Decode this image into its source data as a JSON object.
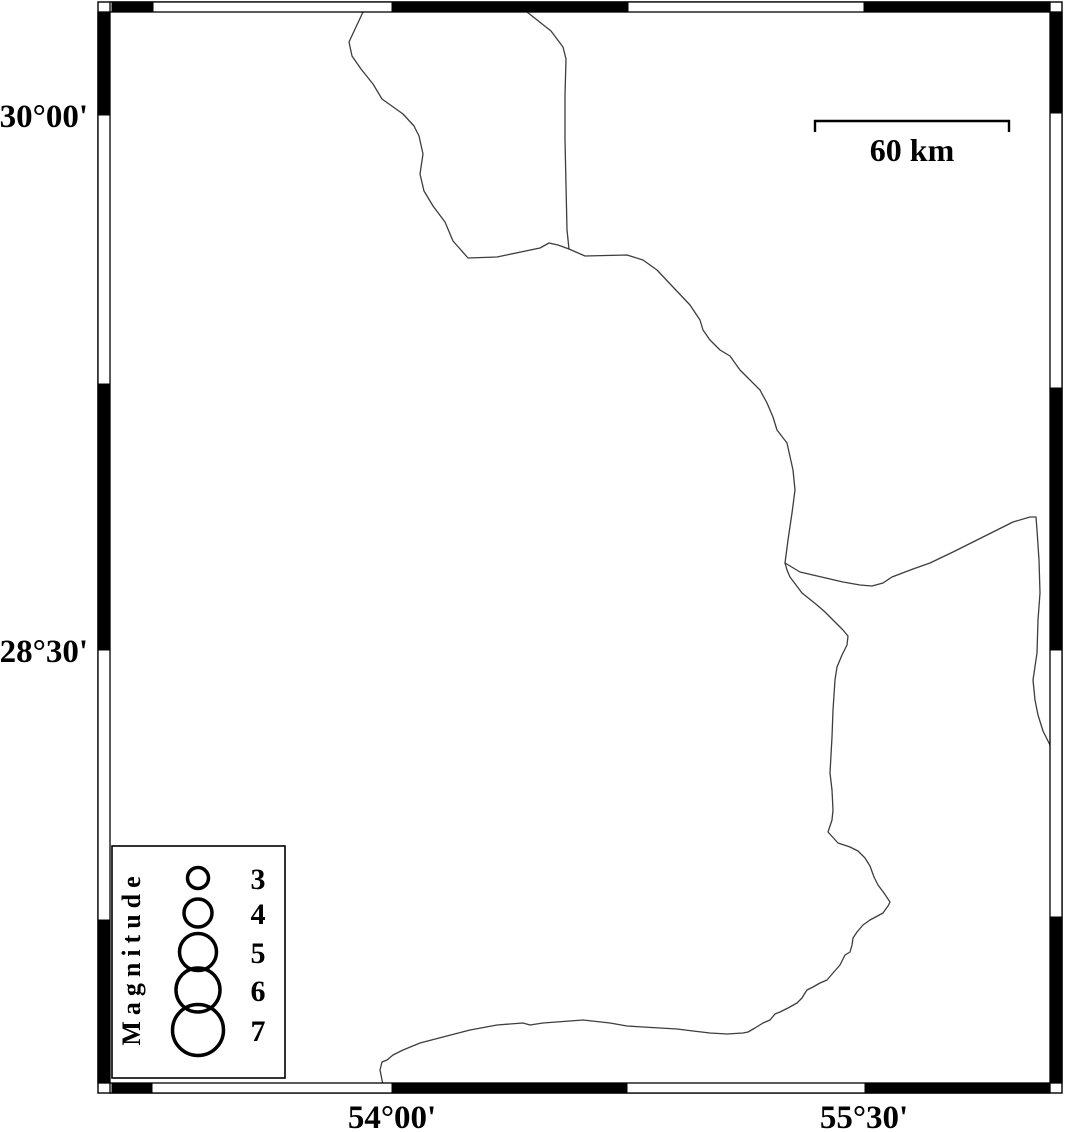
{
  "colors": {
    "background": "#ffffff",
    "frame_black": "#000000",
    "frame_white": "#ffffff",
    "coastline": "#3d3d3d",
    "text": "#000000"
  },
  "frame": {
    "outer_rect": [
      98,
      2,
      964,
      1091
    ],
    "bands": {
      "top": [
        110,
        2,
        940,
        10
      ],
      "bottom": [
        110,
        1083,
        940,
        10
      ],
      "left": [
        98,
        12,
        12,
        1071
      ],
      "right": [
        1050,
        12,
        12,
        1071
      ]
    },
    "black_segments": [
      [
        112,
        2,
        41,
        10
      ],
      [
        392,
        2,
        236,
        10
      ],
      [
        864,
        2,
        186,
        10
      ],
      [
        112,
        1083,
        40,
        10
      ],
      [
        392,
        1083,
        235,
        10
      ],
      [
        865,
        1083,
        185,
        10
      ],
      [
        98,
        12,
        12,
        103
      ],
      [
        98,
        384,
        12,
        266
      ],
      [
        98,
        920,
        12,
        163
      ],
      [
        1050,
        12,
        12,
        101
      ],
      [
        1050,
        388,
        12,
        262
      ],
      [
        1050,
        917,
        12,
        166
      ]
    ],
    "lat_labels": [
      {
        "text": "30°00'",
        "x": 88,
        "y": 127
      },
      {
        "text": "28°30'",
        "x": 88,
        "y": 662
      }
    ],
    "lon_labels": [
      {
        "text": "54°00'",
        "x": 392,
        "y": 1128
      },
      {
        "text": "55°30'",
        "x": 864,
        "y": 1128
      }
    ]
  },
  "scale_bar": {
    "label": "60 km",
    "x1": 815,
    "x2": 1009,
    "y_line": 121,
    "tick_drop": 11,
    "label_x": 912,
    "label_y": 161
  },
  "legend": {
    "title": "Magnitude",
    "box": {
      "x": 112,
      "y": 846,
      "w": 173,
      "h": 232
    },
    "title_cx": 140,
    "title_cy": 958,
    "circle_x": 198,
    "value_x": 258,
    "entries": [
      {
        "label": "3",
        "y": 878,
        "r": 10.5
      },
      {
        "label": "4",
        "y": 913,
        "r": 14
      },
      {
        "label": "5",
        "y": 952,
        "r": 18.5
      },
      {
        "label": "6",
        "y": 990,
        "r": 22
      },
      {
        "label": "7",
        "y": 1030,
        "r": 25.5
      }
    ]
  },
  "map": {
    "polylines": [
      {
        "name": "boundary-northwest",
        "points": [
          363,
          12,
          349,
          42,
          352,
          56,
          361,
          69,
          373,
          84,
          382,
          99,
          403,
          114,
          414,
          126,
          419,
          136,
          423,
          154,
          420,
          174,
          424,
          191,
          433,
          206,
          445,
          222,
          453,
          241,
          468,
          258,
          497,
          257,
          540,
          248,
          549,
          243,
          558,
          245,
          569,
          249
        ]
      },
      {
        "name": "boundary-north",
        "points": [
          527,
          12,
          551,
          31,
          563,
          47,
          566,
          59,
          565,
          95,
          565,
          140,
          566,
          185,
          567,
          230,
          569,
          249
        ]
      },
      {
        "name": "boundary-central",
        "points": [
          569,
          249,
          585,
          256,
          627,
          255,
          643,
          260,
          657,
          270,
          673,
          287,
          690,
          305,
          700,
          320,
          703,
          330,
          710,
          340,
          720,
          350,
          730,
          356,
          740,
          370,
          750,
          380,
          760,
          390,
          767,
          403,
          773,
          417,
          777,
          430,
          787,
          443,
          793,
          470,
          795,
          490,
          792,
          513,
          788,
          540,
          785,
          563
        ]
      },
      {
        "name": "boundary-east",
        "points": [
          785,
          563,
          800,
          572,
          843,
          582,
          860,
          585,
          872,
          586,
          883,
          583,
          892,
          577,
          913,
          569,
          930,
          563,
          953,
          552,
          973,
          542,
          993,
          532,
          1013,
          522,
          1030,
          517,
          1036,
          517,
          1037,
          530,
          1039,
          560,
          1040,
          593,
          1038,
          620,
          1037,
          653,
          1033,
          680,
          1035,
          700,
          1038,
          715,
          1043,
          731,
          1050,
          745
        ]
      },
      {
        "name": "boundary-south",
        "points": [
          785,
          563,
          787,
          570,
          790,
          577,
          802,
          593,
          817,
          605,
          825,
          612,
          833,
          620,
          843,
          630,
          848,
          636,
          847,
          645,
          842,
          655,
          837,
          667,
          835,
          680,
          833,
          710,
          832,
          737,
          830,
          773,
          832,
          790,
          833,
          810,
          832,
          820,
          828,
          832,
          838,
          843,
          850,
          847,
          858,
          851,
          865,
          858,
          870,
          866,
          874,
          877,
          878,
          885,
          884,
          893,
          890,
          902,
          888,
          906,
          883,
          913,
          870,
          920,
          863,
          925,
          857,
          932,
          853,
          938,
          852,
          945,
          850,
          952,
          845,
          955,
          840,
          965,
          833,
          973,
          827,
          980,
          820,
          983,
          813,
          987,
          807,
          990,
          805,
          993,
          802,
          998,
          797,
          1003,
          788,
          1008,
          780,
          1012,
          775,
          1014,
          770,
          1020,
          763,
          1023,
          755,
          1028,
          748,
          1032,
          743,
          1033,
          727,
          1034,
          710,
          1033,
          693,
          1031,
          677,
          1029,
          660,
          1028,
          643,
          1027,
          627,
          1026,
          610,
          1023,
          583,
          1020,
          543,
          1023,
          530,
          1025,
          523,
          1023,
          497,
          1025,
          470,
          1030,
          443,
          1037,
          420,
          1043,
          403,
          1050,
          393,
          1055,
          387,
          1060,
          382,
          1062,
          380,
          1070,
          382,
          1080,
          383,
          1085
        ]
      }
    ]
  }
}
